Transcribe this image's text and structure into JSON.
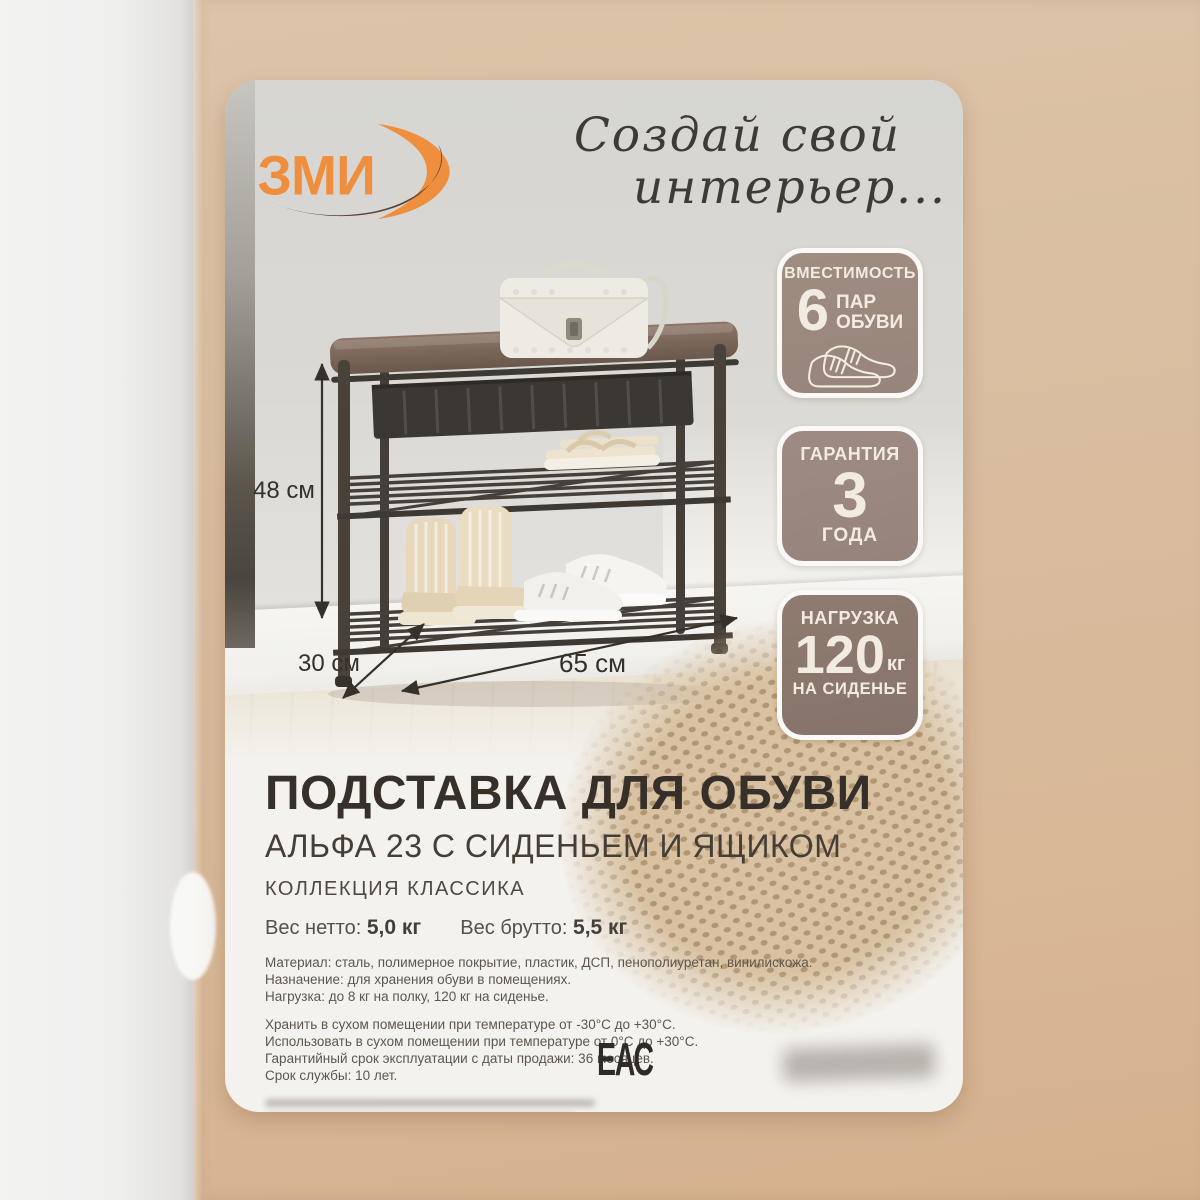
{
  "brand": {
    "logo_text": "ЗМИ",
    "slogan_line1": "Создай свой",
    "slogan_line2": "интерьер..."
  },
  "badges": [
    {
      "title": "ВМЕСТИМОСТЬ",
      "big": "6",
      "line1": "ПАР",
      "line2": "ОБУВИ",
      "icon": "shoes-outline-icon"
    },
    {
      "title": "ГАРАНТИЯ",
      "big": "3",
      "sub": "ГОДА"
    },
    {
      "title": "НАГРУЗКА",
      "big": "120",
      "unit": "кг",
      "sub": "НА СИДЕНЬЕ"
    }
  ],
  "dimensions": {
    "height": "48 см",
    "depth": "30 см",
    "width": "65 см"
  },
  "product": {
    "title": "ПОДСТАВКА ДЛЯ ОБУВИ",
    "subtitle": "АЛЬФА 23 С СИДЕНЬЕМ И ЯЩИКОМ",
    "collection": "КОЛЛЕКЦИЯ КЛАССИКА",
    "weights": {
      "net_label": "Вес нетто:",
      "net_value": "5,0 кг",
      "gross_label": "Вес брутто:",
      "gross_value": "5,5 кг"
    },
    "specs": [
      "Материал: сталь, полимерное покрытие, пластик, ДСП, пенополиуретан, винилискожа.",
      "Назначение: для хранения обуви в помещениях.",
      "Нагрузка: до 8 кг на полку, 120 кг на сиденье."
    ],
    "care": [
      "Хранить в сухом помещении при температуре  от -30°С до +30°С.",
      "Использовать в сухом помещении при температуре от 0°С до +30°С.",
      "Гарантийный срок эксплуатации с даты продажи: 36 месяцев.",
      "Срок службы: 10 лет."
    ]
  },
  "certification": {
    "eac_mark": "ЕАС"
  },
  "colors": {
    "accent_orange": "#ef8f3d",
    "logo_dark": "#5d473c",
    "cardboard": "#d9bda0",
    "label_background": "#f4f2ee",
    "badge_taupe": "#9a877c",
    "badge_dark_taupe": "#8c786c",
    "badge_text": "#f2ebe2",
    "title_text": "#37302a",
    "body_text": "#5e564c"
  }
}
